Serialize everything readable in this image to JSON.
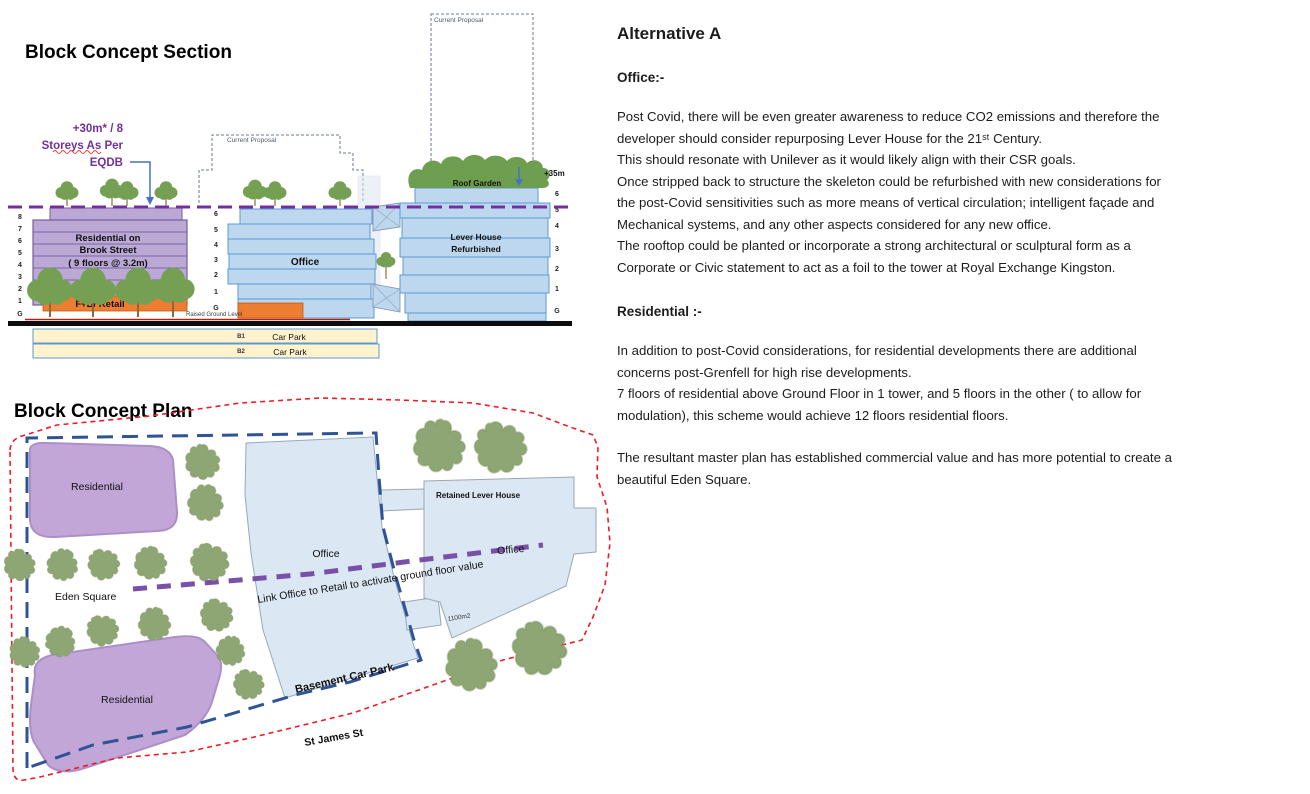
{
  "colors": {
    "residential_purple": "#BCA8D4",
    "purple_stroke": "#6F5FA0",
    "office_blue": "#BDD7EE",
    "building_stroke": "#5B9BD5",
    "retail_orange": "#ED7D31",
    "car_park_yellow": "#FFF2CC",
    "tree_green_section": "#75A054",
    "tree_green_plan": "#8EA673",
    "roof_garden_green": "#6E9E50",
    "boundary_red": "#EE1C25",
    "boundary_blue": "#2F5496",
    "link_purple": "#7A4FA8",
    "annotation_purple": "#7030A0",
    "leader_blue": "#4472C4"
  },
  "section": {
    "title": "Block Concept Section",
    "annotation": {
      "line1": "+30m* / 8",
      "line2": "Storeys As Per",
      "line3": "EQDB"
    },
    "current_proposal_mid": "Current Proposal",
    "current_proposal_right": "Current Proposal",
    "residential": {
      "name_line1": "Residential on",
      "name_line2": "Brook Street",
      "name_line3": "( 9 floors @ 3.2m)",
      "floors": [
        "8",
        "7",
        "6",
        "5",
        "4",
        "3",
        "2",
        "1",
        "G"
      ],
      "retail": "F+B/ Retail"
    },
    "office": {
      "label": "Office",
      "floors": [
        "6",
        "5",
        "4",
        "3",
        "2",
        "1",
        "G"
      ],
      "raised_ground": "Raised Ground Level"
    },
    "lever": {
      "name_line1": "Lever House",
      "name_line2": "Refurbished",
      "floors": [
        "6",
        "5",
        "4",
        "3",
        "2",
        "1",
        "G"
      ],
      "roof_garden": "Roof Garden",
      "height": "+35m"
    },
    "car_park": {
      "b1": "B1",
      "label_b1": "Car Park",
      "b2": "B2",
      "label_b2": "Car Park"
    }
  },
  "plan": {
    "title": "Block Concept Plan",
    "residential_top": "Residential",
    "residential_bottom": "Residential",
    "office_left": "Office",
    "office_right": "Office",
    "retained": "Retained Lever House",
    "area": "1100m2",
    "eden_square": "Eden Square",
    "link": "Link Office to Retail to activate ground floor value",
    "basement": "Basement Car Park",
    "street": "St James St"
  },
  "content": {
    "heading": "Alternative A",
    "office_heading": "Office:-",
    "office_paragraph": "Post Covid, there will be even greater awareness to reduce CO2 emissions and therefore the\ndeveloper should consider repurposing  Lever House for the 21ˢᵗ Century.\nThis should resonate with Unilever as it would likely align with their CSR goals.\nOnce stripped back to structure the skeleton could be refurbished with new considerations for\nthe post-Covid sensitivities such as more means of vertical circulation; intelligent façade and\nMechanical systems, and any other aspects considered for any new office.\nThe rooftop could be planted or incorporate a strong architectural or sculptural form as a\nCorporate or Civic statement to act as a foil to the tower at Royal Exchange Kingston.",
    "residential_heading": "Residential :-",
    "residential_paragraph": "In addition to post-Covid considerations, for residential developments there are additional\nconcerns post-Grenfell for high rise developments.\n7 floors of residential above Ground Floor in 1 tower, and 5 floors in the other ( to allow for\nmodulation), this scheme would achieve 12 floors residential  floors.",
    "closing_paragraph": "The resultant master plan has established commercial value and has more potential to create a\nbeautiful Eden Square."
  }
}
